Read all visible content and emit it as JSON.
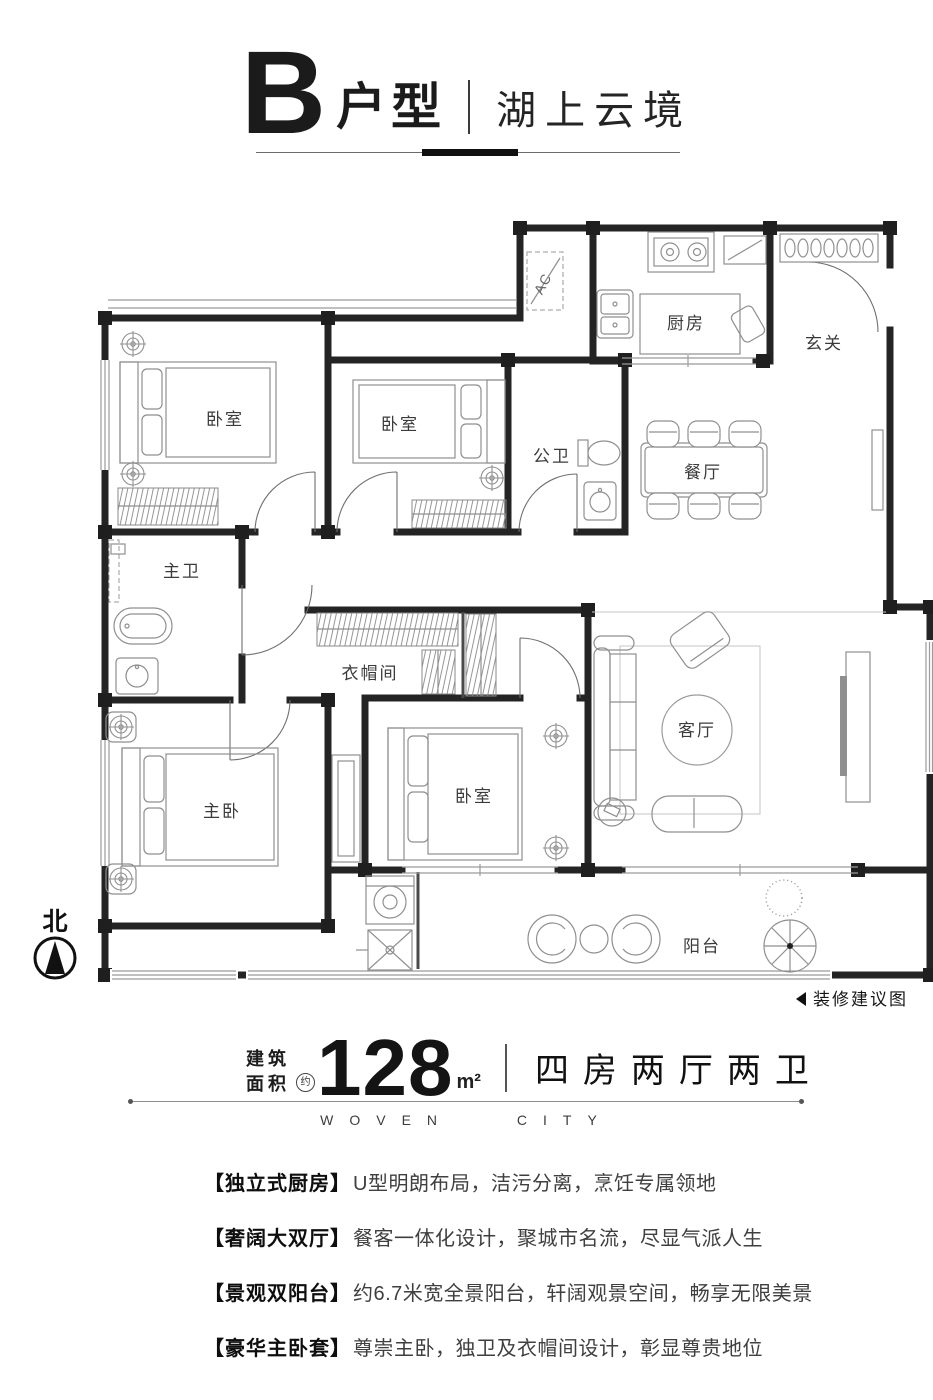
{
  "colors": {
    "ink": "#1a1a1a",
    "wall": "#242424",
    "furniture_line": "#8f8f8f"
  },
  "header": {
    "unit_letter": "B",
    "unit_label": "户型",
    "project_name": "湖上云境"
  },
  "plan": {
    "compass_label": "北",
    "note_label": "装修建议图",
    "icons": {
      "compass": "north-compass-icon",
      "note_marker": "left-triangle-icon"
    },
    "rooms": {
      "bedroom_top_left": "卧室",
      "bedroom_top_mid": "卧室",
      "guest_bath": "公卫",
      "kitchen": "厨房",
      "foyer": "玄关",
      "dining": "餐厅",
      "master_bath": "主卫",
      "cloakroom": "衣帽间",
      "master_bedroom": "主卧",
      "bedroom_bottom": "卧室",
      "living_room": "客厅",
      "balcony": "阳台",
      "ac_unit": "AC"
    }
  },
  "area": {
    "label_line1": "建筑",
    "label_line2": "面积",
    "approx_badge": "约",
    "value": "128",
    "unit": "m²",
    "layout_desc": "四房两厅两卫",
    "tagline": "WOVEN CITY"
  },
  "features": [
    {
      "head": "【独立式厨房】",
      "text": "U型明朗布局，洁污分离，烹饪专属领地"
    },
    {
      "head": "【奢阔大双厅】",
      "text": "餐客一体化设计，聚城市名流，尽显气派人生"
    },
    {
      "head": "【景观双阳台】",
      "text": "约6.7米宽全景阳台，轩阔观景空间，畅享无限美景"
    },
    {
      "head": "【豪华主卧套】",
      "text": "尊崇主卧，独卫及衣帽间设计，彰显尊贵地位"
    }
  ]
}
